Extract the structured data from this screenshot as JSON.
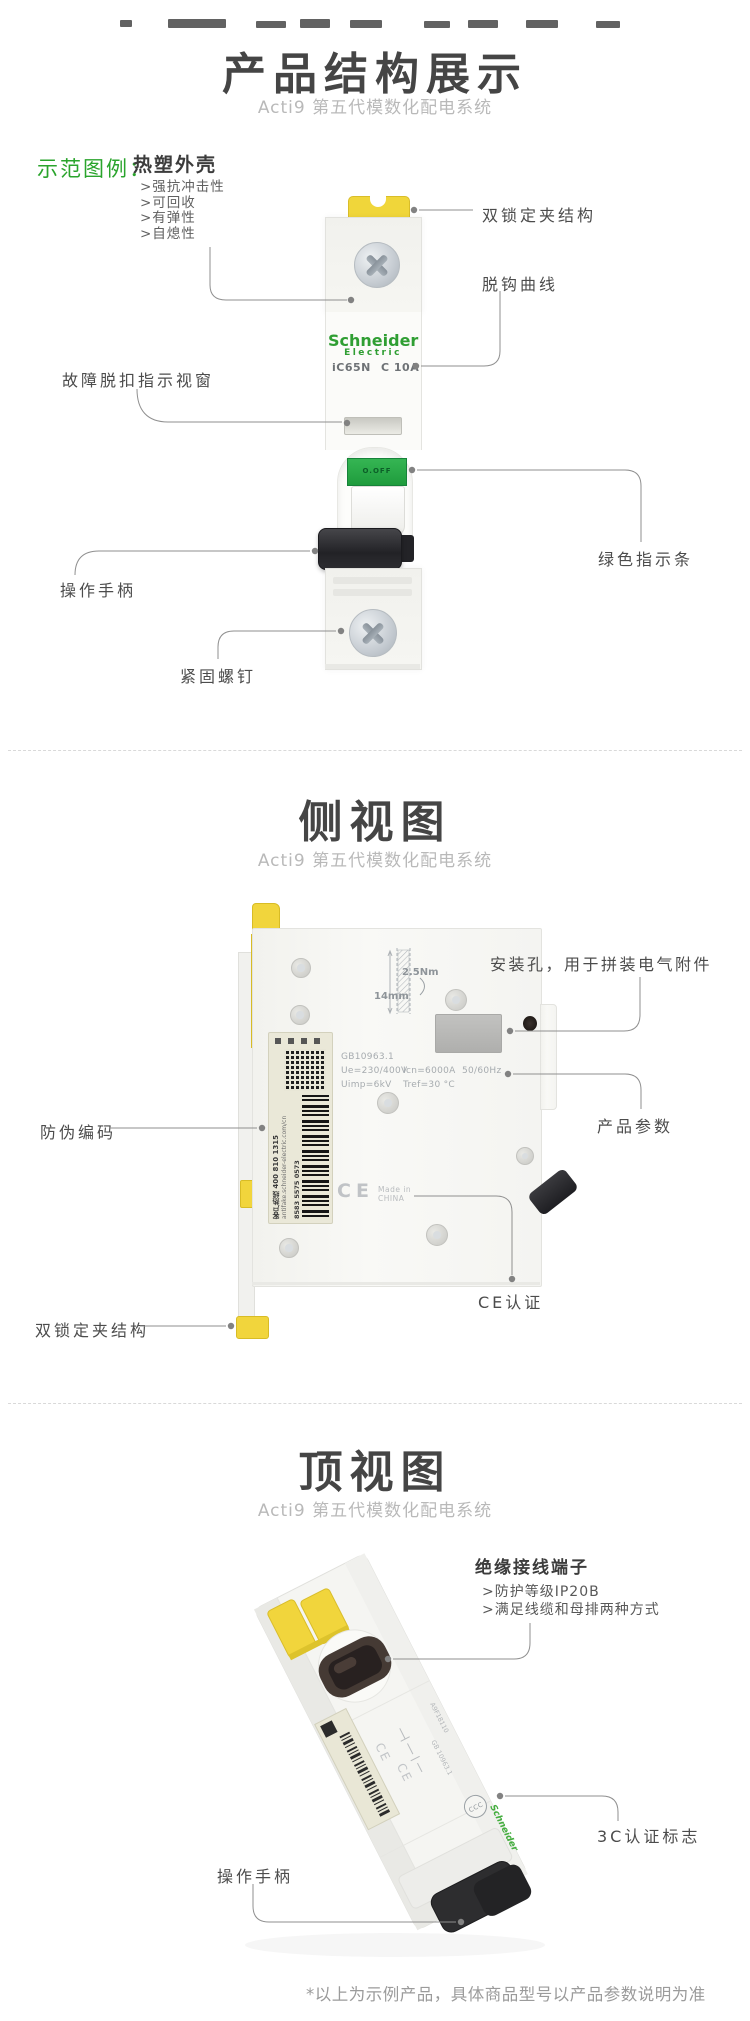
{
  "header1": {
    "title": "产品结构展示",
    "subtitle": "Acti9 第五代模数化配电系统"
  },
  "legend": {
    "label": "示范图例：",
    "shell_title": "热塑外壳",
    "shell_bullets": [
      ">强抗冲击性",
      ">可回收",
      ">有弹性",
      ">自熄性"
    ]
  },
  "device": {
    "brand": "Schneider",
    "brand_sub": "Electric",
    "model": "iC65N",
    "rating": "C 10A",
    "strip": "O.OFF"
  },
  "callouts1": {
    "dual_lock": "双锁定夹结构",
    "trip_curve": "脱钩曲线",
    "fault_window": "故障脱扣指示视窗",
    "green_bar": "绿色指示条",
    "handle": "操作手柄",
    "screw": "紧固螺钉"
  },
  "header2": {
    "title": "侧视图",
    "subtitle": "Acti9 第五代模数化配电系统"
  },
  "callouts2": {
    "mount_hole": "安装孔，用于拼装电气附件",
    "anti_fake": "防伪编码",
    "params": "产品参数",
    "ce": "CE认证",
    "dual_lock": "双锁定夹结构"
  },
  "side_markings": {
    "torque": "2.5Nm",
    "width": "14mm",
    "std": "GB10963.1",
    "ue": "Ue=230/400V",
    "icn": "Icn=6000A",
    "freq": "50/60Hz",
    "uimp": "Uimp=6kV",
    "tref": "Tref=30 °C",
    "ce": "CE",
    "made1": "Made in",
    "made2": "CHINA",
    "hotline": "客户热线 400 810 1315",
    "url": "antifake.schneider-electric.com/cn",
    "code": "8583 5575 0573"
  },
  "header3": {
    "title": "顶视图",
    "subtitle": "Acti9 第五代模数化配电系统"
  },
  "terminal": {
    "title": "绝缘接线端子",
    "bullets": [
      ">防护等级IP20B",
      ">满足线缆和母排两种方式"
    ]
  },
  "callouts3": {
    "ccc": "3C认证标志",
    "handle": "操作手柄"
  },
  "top_markings": {
    "std": "GB 10963.1",
    "ref": "A9F18110",
    "brand": "Schneider",
    "ccc": "CCC",
    "ce1": "CE",
    "ce2": "CE"
  },
  "footer": {
    "note": "*以上为示例产品，具体商品型号以产品参数说明为准"
  }
}
